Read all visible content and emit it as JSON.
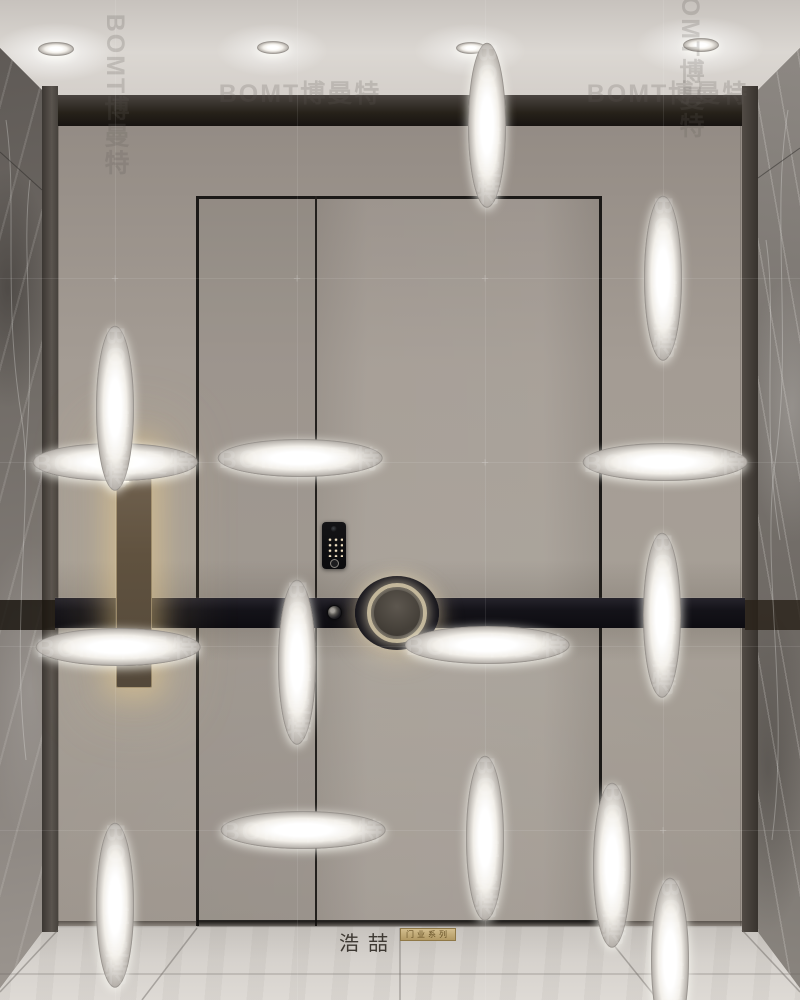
{
  "scene": {
    "type": "entry-door-render",
    "room_number": "302",
    "logo": {
      "title": "浩喆",
      "subtitle": "门业系列"
    },
    "colors": {
      "wall": "#a39b93",
      "accent_band": "#14131a",
      "sign_plaque": "#60523f",
      "sign_glow": "#f3d38e",
      "marble_dark": "#6a6560",
      "marble_light": "#8a8580",
      "ceiling": "#d8d4cf",
      "floor": "#d6d2cd",
      "badge_gold": "#b29964"
    },
    "ceiling_lights": [
      {
        "x": 38,
        "y": 42,
        "w": 36,
        "h": 14
      },
      {
        "x": 257,
        "y": 41,
        "w": 32,
        "h": 13
      },
      {
        "x": 456,
        "y": 42,
        "w": 30,
        "h": 12
      },
      {
        "x": 683,
        "y": 38,
        "w": 36,
        "h": 14
      }
    ],
    "watermarks": {
      "text": "BOMT博曼特",
      "grid_v": [
        115,
        297,
        485,
        663
      ],
      "grid_h": [
        278,
        462,
        646,
        830
      ],
      "instances": [
        {
          "x": 300,
          "y": 92,
          "orient": "h",
          "tone": "dark"
        },
        {
          "x": 668,
          "y": 92,
          "orient": "h",
          "tone": "dark"
        },
        {
          "x": 115,
          "y": 462,
          "orient": "h",
          "tone": "light"
        },
        {
          "x": 300,
          "y": 458,
          "orient": "h",
          "tone": "light"
        },
        {
          "x": 665,
          "y": 462,
          "orient": "h",
          "tone": "light"
        },
        {
          "x": 118,
          "y": 647,
          "orient": "h",
          "tone": "light"
        },
        {
          "x": 487,
          "y": 645,
          "orient": "h",
          "tone": "light"
        },
        {
          "x": 303,
          "y": 830,
          "orient": "h",
          "tone": "light"
        },
        {
          "x": 115,
          "y": 95,
          "orient": "v",
          "tone": "dark"
        },
        {
          "x": 690,
          "y": 58,
          "orient": "v",
          "tone": "dark"
        },
        {
          "x": 487,
          "y": 125,
          "orient": "v",
          "tone": "light"
        },
        {
          "x": 663,
          "y": 278,
          "orient": "v",
          "tone": "light"
        },
        {
          "x": 115,
          "y": 408,
          "orient": "v",
          "tone": "light"
        },
        {
          "x": 662,
          "y": 615,
          "orient": "v",
          "tone": "light"
        },
        {
          "x": 297,
          "y": 662,
          "orient": "v",
          "tone": "light"
        },
        {
          "x": 485,
          "y": 838,
          "orient": "v",
          "tone": "light"
        },
        {
          "x": 612,
          "y": 865,
          "orient": "v",
          "tone": "light"
        },
        {
          "x": 115,
          "y": 905,
          "orient": "v",
          "tone": "light"
        },
        {
          "x": 670,
          "y": 960,
          "orient": "v",
          "tone": "light"
        }
      ]
    }
  }
}
